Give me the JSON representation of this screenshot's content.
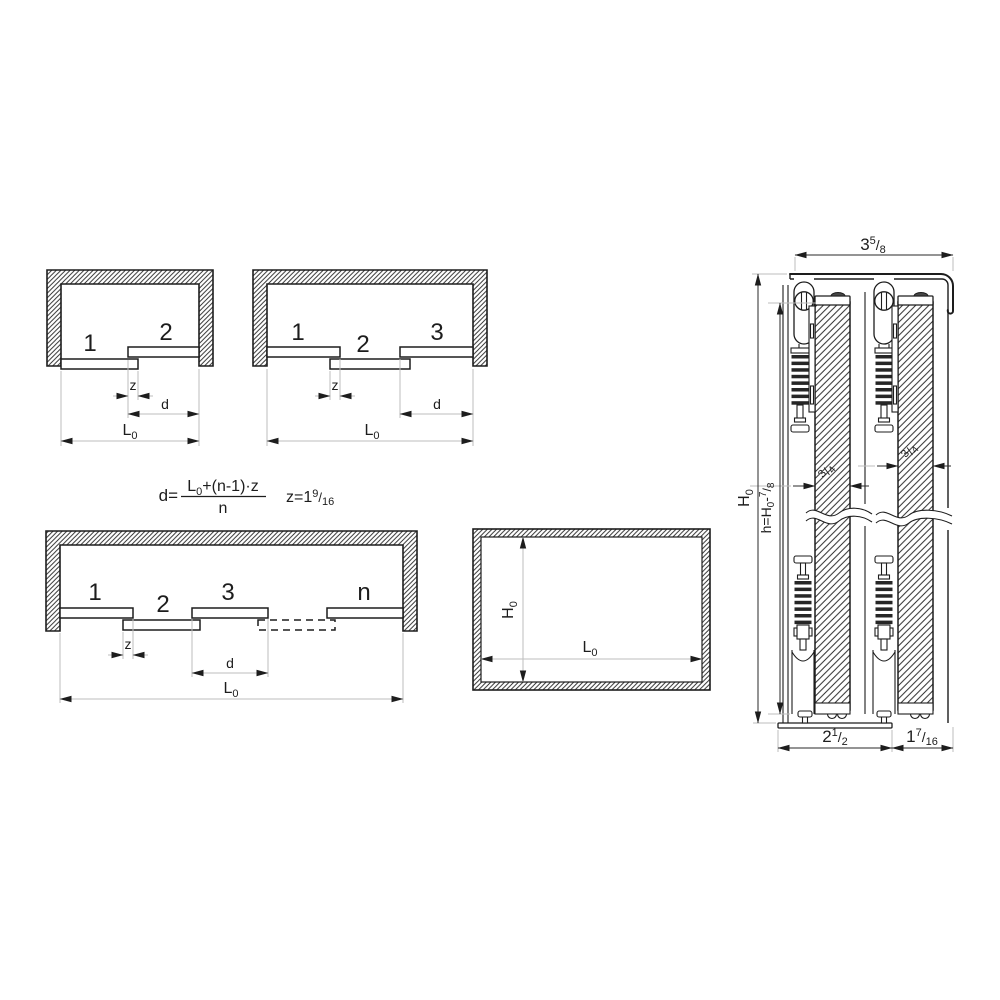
{
  "drawing_title": "sliding-door-system-technical-drawing",
  "colors": {
    "line": "#1d1d1d",
    "dimension_line": "#bdbdbd",
    "spring_coil": "#262626",
    "foot_cap_fill": "#9e9e9e",
    "screw_head_fill": "#474747",
    "background": "#ffffff"
  },
  "panel_labels": {
    "one": "1",
    "two": "2",
    "three": "3",
    "n": "n"
  },
  "dim_labels": {
    "z": "z",
    "d": "d",
    "L": "L",
    "L_sub": "0",
    "H": "H",
    "H_sub": "0"
  },
  "formula": {
    "lhs": "d=",
    "numerator_L": "L",
    "numerator_sub": "0",
    "numerator_rest": "+(n-1)·z",
    "denominator": "n",
    "z_value_main": "z=1",
    "z_value_sup": "9",
    "z_value_slash": "/",
    "z_value_sub": "16"
  },
  "section_dims": {
    "track_width": {
      "main": "3",
      "sup": "5",
      "slash": "/",
      "sub": "8"
    },
    "door_thickness": {
      "sup": "3",
      "slash": "/",
      "sub": "4"
    },
    "height_formula": {
      "main": "h=H",
      "sub0": "0",
      "minus": "-",
      "sup": "7",
      "slash": "/",
      "sub": "8"
    },
    "bottom_left": {
      "main": "2",
      "sup": "1",
      "slash": "/",
      "sub": "2"
    },
    "bottom_right": {
      "main": "1",
      "sup": "7",
      "slash": "/",
      "sub": "16"
    }
  }
}
